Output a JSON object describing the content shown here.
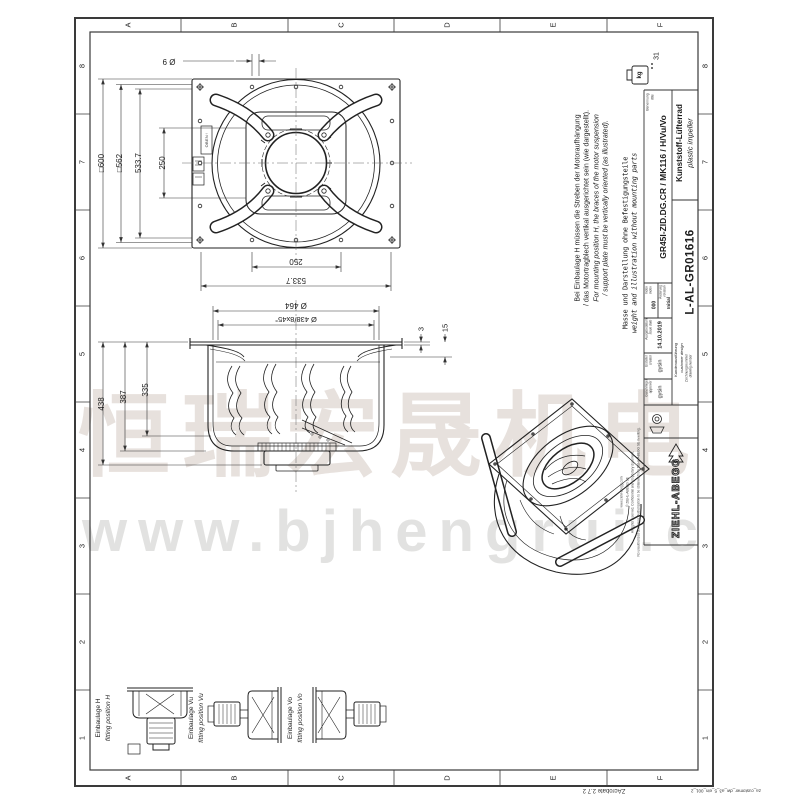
{
  "sheet": {
    "letters": [
      "A",
      "B",
      "C",
      "D",
      "E",
      "F"
    ],
    "numbers": [
      "8",
      "7",
      "6",
      "5",
      "4",
      "3",
      "2",
      "1"
    ],
    "footer_stamp": "ZAcrobate  2.7 2",
    "template_id": "za_customer_dw_a3_5_ein_001_2"
  },
  "weight_stamp": {
    "unit": "kg",
    "colon": ":",
    "value": "31"
  },
  "notes": {
    "de1": "Bei Einbaulage H müssen die Streben der Motoraufhängung",
    "de2": "/ das Motortragblech vertikal ausgerichtet sein (wie dargestellt).",
    "en1": "For mounting position H, the braces of the motor suspension",
    "en2": "/ support plate must be vertically oriented (as illustrated).",
    "mass_de": "Masse und Darstellung ohne Befestigungsteile",
    "mass_en": "weight and illustration without mounting parts"
  },
  "title_block": {
    "benennung_label": "Benennung",
    "benennung_label_en": "title",
    "title_value": "GR45I-ZID.DG.CR / MK116 / H/Vu/Vo",
    "product_de": "Kunststoff-Lüfterrad",
    "product_en": "plastic impeller",
    "index_label": "Index",
    "index_label_en": "index",
    "index_value": "000",
    "revision_label": "Änderung",
    "revision_label_en": "revision",
    "revision_value": "Initial",
    "issue_label": "Ausgabedatum",
    "issue_label_en": "issue date",
    "issue_value": "14.10.2019",
    "creator_label": "Ersteller",
    "creator_label_en": "creator",
    "creator_value": "gysin",
    "approver_label": "Genehmiger",
    "approver_label_en": "approver",
    "approver_value": "gysin",
    "design_label": "Kundenausführung",
    "design_label_en": "customer design",
    "number_label": "Zeichnungsnummer",
    "number_label_en": "drawing number",
    "number_value": "L-AL-GR01616",
    "company": "ZIEHL-ABEGG",
    "legal": [
      "www.ziehl-abegg.com",
      "© ZIEHL-ABEGG SE",
      "All rights reserved. Confidential and proprietary document.",
      "No unauthorized disclosure. Authorization to be obtained from ZIEHL-ABEGG SE in writing."
    ]
  },
  "dimensions": {
    "sq600": "□600",
    "sq562": "□562",
    "d5337_v": "533.7",
    "d250_v": "250",
    "hole9": "Ø 9",
    "d250_h": "250",
    "d5337_h": "533.7",
    "d464": "Ø 464",
    "d438_8x45": "Ø 438/8x45°",
    "h438": "438",
    "h387": "387",
    "h335": "335",
    "t3": "3",
    "t15": "15",
    "oben": "OBEN↑"
  },
  "fitting_positions": [
    {
      "de": "Einbaulage H",
      "en": "fitting position H"
    },
    {
      "de": "Einbaulage Vu",
      "en": "fitting position Vu"
    },
    {
      "de": "Einbaulage Vo",
      "en": "fitting position Vo"
    }
  ],
  "watermark": {
    "cn": "恒瑞宏晟机电",
    "url": "www.bjhengrui.c"
  }
}
